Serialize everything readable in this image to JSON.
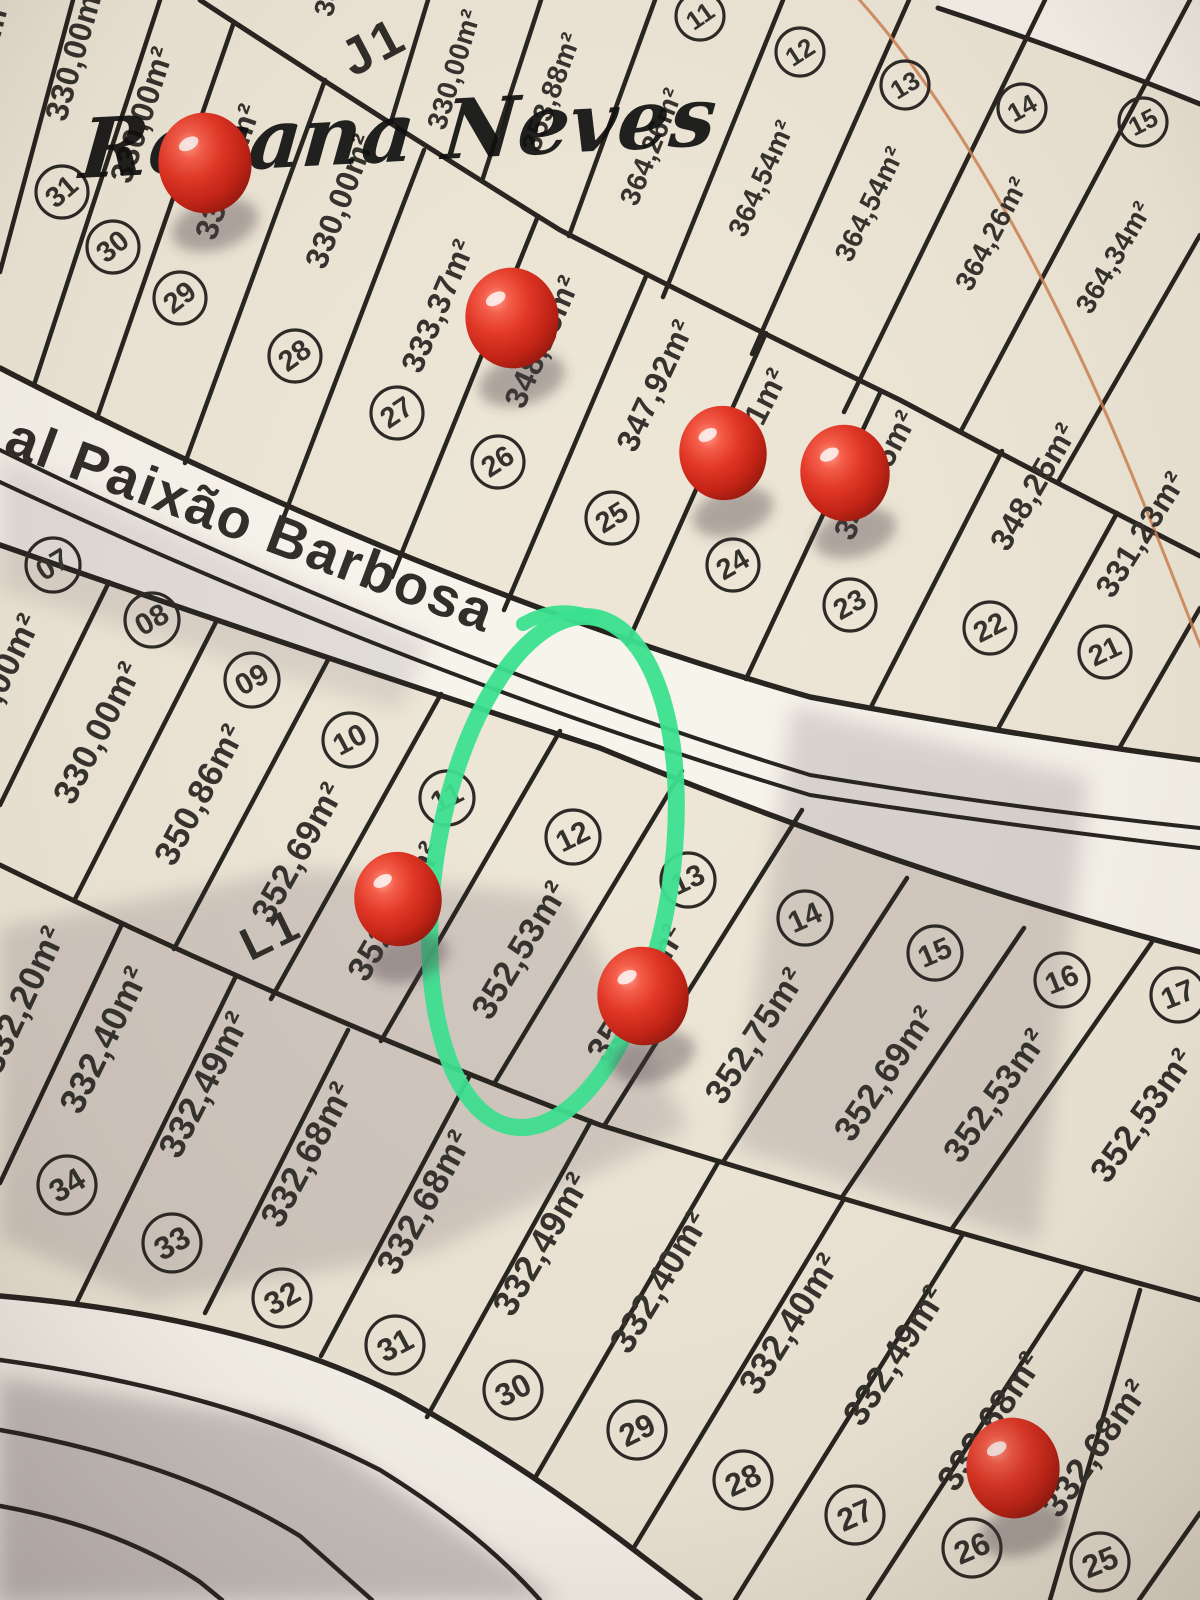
{
  "watermark": "Rosana Neves",
  "street": {
    "label": "al Paixão Barbosa"
  },
  "block_labels": [
    {
      "text": "J1",
      "x": 382,
      "y": 62,
      "rot": -28,
      "size": 52
    },
    {
      "text": "L1",
      "x": 278,
      "y": 948,
      "rot": -26,
      "size": 46
    }
  ],
  "colors": {
    "paper": "#ede6d6",
    "street": "#f7f4eb",
    "ink": "#33302c",
    "line": "#26221e",
    "green_marker": "#3be08f",
    "orange_line": "#cc8050",
    "pin_red": "#e03325",
    "shadow": "#8b7e84"
  },
  "lots": [
    {
      "row": "Jl",
      "number": null,
      "area": "330,00m²",
      "nx": null,
      "ny": null,
      "ax": -8,
      "ay": 68,
      "rot": -75
    },
    {
      "row": "Jl",
      "number": "31",
      "area": "330,00m²",
      "nx": 62,
      "ny": 192,
      "ax": 85,
      "ay": 55,
      "rot": -74
    },
    {
      "row": "Jl",
      "number": "30",
      "area": "330,00m²",
      "nx": 113,
      "ny": 247,
      "ax": 152,
      "ay": 118,
      "rot": -72
    },
    {
      "row": "Jl",
      "number": "29",
      "area": "330,00m²",
      "nx": 180,
      "ny": 298,
      "ax": 238,
      "ay": 175,
      "rot": -71
    },
    {
      "row": "Jl",
      "number": "28",
      "area": "330,00m²",
      "nx": 295,
      "ny": 356,
      "ax": 350,
      "ay": 205,
      "rot": -69
    },
    {
      "row": "Jl",
      "number": "27",
      "area": "333,37m²",
      "nx": 397,
      "ny": 413,
      "ax": 448,
      "ay": 310,
      "rot": -67
    },
    {
      "row": "Jl",
      "number": "26",
      "area": "348,25m²",
      "nx": 498,
      "ny": 462,
      "ax": 552,
      "ay": 346,
      "rot": -66
    },
    {
      "row": "Jl",
      "number": "25",
      "area": "347,92m²",
      "nx": 612,
      "ny": 518,
      "ax": 665,
      "ay": 390,
      "rot": -65
    },
    {
      "row": "Jl",
      "number": "24",
      "area": "347,51m²",
      "nx": 733,
      "ny": 565,
      "ax": 757,
      "ay": 438,
      "rot": -63
    },
    {
      "row": "Jl",
      "number": "23",
      "area": "348,25m²",
      "nx": 850,
      "ny": 605,
      "ax": 885,
      "ay": 480,
      "rot": -62
    },
    {
      "row": "Jl",
      "number": "22",
      "area": "348,25m²",
      "nx": 990,
      "ny": 628,
      "ax": 1043,
      "ay": 492,
      "rot": -60
    },
    {
      "row": "Jl",
      "number": "21",
      "area": "331,23m²",
      "nx": 1105,
      "ny": 652,
      "ax": 1150,
      "ay": 540,
      "rot": -58
    },
    {
      "row": "Ju",
      "number": null,
      "area": "330,00m²",
      "nx": null,
      "ny": null,
      "ax": 348,
      "ay": -42,
      "rot": -75
    },
    {
      "row": "Ju",
      "number": null,
      "area": "330,00m²",
      "nx": null,
      "ny": null,
      "ax": 463,
      "ay": 72,
      "rot": -73
    },
    {
      "row": "Ju",
      "number": null,
      "area": "353,88m²",
      "nx": null,
      "ny": null,
      "ax": 560,
      "ay": 95,
      "rot": -70
    },
    {
      "row": "Ju",
      "number": "11",
      "area": "364,26m²",
      "nx": 700,
      "ny": 16,
      "ax": 660,
      "ay": 150,
      "rot": -68
    },
    {
      "row": "Ju",
      "number": "12",
      "area": "364,54m²",
      "nx": 800,
      "ny": 52,
      "ax": 770,
      "ay": 182,
      "rot": -66
    },
    {
      "row": "Ju",
      "number": "13",
      "area": "364,54m²",
      "nx": 905,
      "ny": 85,
      "ax": 878,
      "ay": 208,
      "rot": -64
    },
    {
      "row": "Ju",
      "number": "14",
      "area": "364,26m²",
      "nx": 1022,
      "ny": 108,
      "ax": 1000,
      "ay": 238,
      "rot": -62
    },
    {
      "row": "Ju",
      "number": "15",
      "area": "364,34m²",
      "nx": 1143,
      "ny": 122,
      "ax": 1122,
      "ay": 262,
      "rot": -60
    },
    {
      "row": "Lm",
      "number": "07",
      "area": "330,00m²",
      "nx": 53,
      "ny": 565,
      "ax": 8,
      "ay": 690,
      "rot": -64
    },
    {
      "row": "Lm",
      "number": "08",
      "area": "330,00m²",
      "nx": 152,
      "ny": 620,
      "ax": 108,
      "ay": 738,
      "rot": -63
    },
    {
      "row": "Lm",
      "number": "09",
      "area": "350,86m²",
      "nx": 252,
      "ny": 680,
      "ax": 210,
      "ay": 800,
      "rot": -62
    },
    {
      "row": "Lm",
      "number": "10",
      "area": "352,69m²",
      "nx": 350,
      "ny": 740,
      "ax": 308,
      "ay": 858,
      "rot": -61
    },
    {
      "row": "Lm",
      "number": "11",
      "area": "352,53m²",
      "nx": 447,
      "ny": 798,
      "ax": 405,
      "ay": 917,
      "rot": -60
    },
    {
      "row": "Lm",
      "number": "12",
      "area": "352,53m²",
      "nx": 573,
      "ny": 837,
      "ax": 530,
      "ay": 956,
      "rot": -59
    },
    {
      "row": "Lm",
      "number": "13",
      "area": "352,75m²",
      "nx": 688,
      "ny": 880,
      "ax": 646,
      "ay": 999,
      "rot": -58
    },
    {
      "row": "Lm",
      "number": "14",
      "area": "352,75m²",
      "nx": 805,
      "ny": 918,
      "ax": 765,
      "ay": 1042,
      "rot": -57
    },
    {
      "row": "Lm",
      "number": "15",
      "area": "352,69m²",
      "nx": 935,
      "ny": 953,
      "ax": 895,
      "ay": 1080,
      "rot": -56
    },
    {
      "row": "Lm",
      "number": "16",
      "area": "352,53m²",
      "nx": 1062,
      "ny": 980,
      "ax": 1005,
      "ay": 1102,
      "rot": -55
    },
    {
      "row": "Lm",
      "number": "17",
      "area": "352,53m²",
      "nx": 1178,
      "ny": 995,
      "ax": 1152,
      "ay": 1122,
      "rot": -55
    },
    {
      "row": "Lb",
      "number": null,
      "area": "332,20m²",
      "nx": null,
      "ny": null,
      "ax": 33,
      "ay": 1005,
      "rot": -65
    },
    {
      "row": "Lb",
      "number": "34",
      "area": "332,40m²",
      "nx": 67,
      "ny": 1185,
      "ax": 115,
      "ay": 1045,
      "rot": -64
    },
    {
      "row": "Lb",
      "number": "33",
      "area": "332,49m²",
      "nx": 172,
      "ny": 1243,
      "ax": 215,
      "ay": 1090,
      "rot": -63
    },
    {
      "row": "Lb",
      "number": "32",
      "area": "332,68m²",
      "nx": 282,
      "ny": 1298,
      "ax": 318,
      "ay": 1160,
      "rot": -62
    },
    {
      "row": "Lb",
      "number": "31",
      "area": "332,68m²",
      "nx": 395,
      "ny": 1345,
      "ax": 435,
      "ay": 1208,
      "rot": -61
    },
    {
      "row": "Lb",
      "number": "30",
      "area": "332,49m²",
      "nx": 513,
      "ny": 1390,
      "ax": 552,
      "ay": 1250,
      "rot": -60
    },
    {
      "row": "Lb",
      "number": "29",
      "area": "332,40m²",
      "nx": 637,
      "ny": 1430,
      "ax": 670,
      "ay": 1288,
      "rot": -59
    },
    {
      "row": "Lb",
      "number": "28",
      "area": "332,40m²",
      "nx": 743,
      "ny": 1480,
      "ax": 800,
      "ay": 1330,
      "rot": -58
    },
    {
      "row": "Lb",
      "number": "27",
      "area": "332,49m²",
      "nx": 855,
      "ny": 1515,
      "ax": 905,
      "ay": 1362,
      "rot": -57
    },
    {
      "row": "Lb",
      "number": "26",
      "area": "332,68m²",
      "nx": 972,
      "ny": 1548,
      "ax": 1000,
      "ay": 1428,
      "rot": -56
    },
    {
      "row": "Lb",
      "number": "25",
      "area": "332,68m²",
      "nx": 1100,
      "ny": 1562,
      "ax": 1105,
      "ay": 1455,
      "rot": -55
    }
  ],
  "pins": [
    {
      "x": 205,
      "y": 163,
      "r": 48
    },
    {
      "x": 512,
      "y": 318,
      "r": 48
    },
    {
      "x": 723,
      "y": 453,
      "r": 45
    },
    {
      "x": 845,
      "y": 473,
      "r": 46
    },
    {
      "x": 398,
      "y": 899,
      "r": 45
    },
    {
      "x": 643,
      "y": 996,
      "r": 47
    },
    {
      "x": 1013,
      "y": 1468,
      "r": 48
    }
  ],
  "highlight": {
    "x": 553,
    "y": 872,
    "rx": 118,
    "ry": 258,
    "rot": 9
  }
}
